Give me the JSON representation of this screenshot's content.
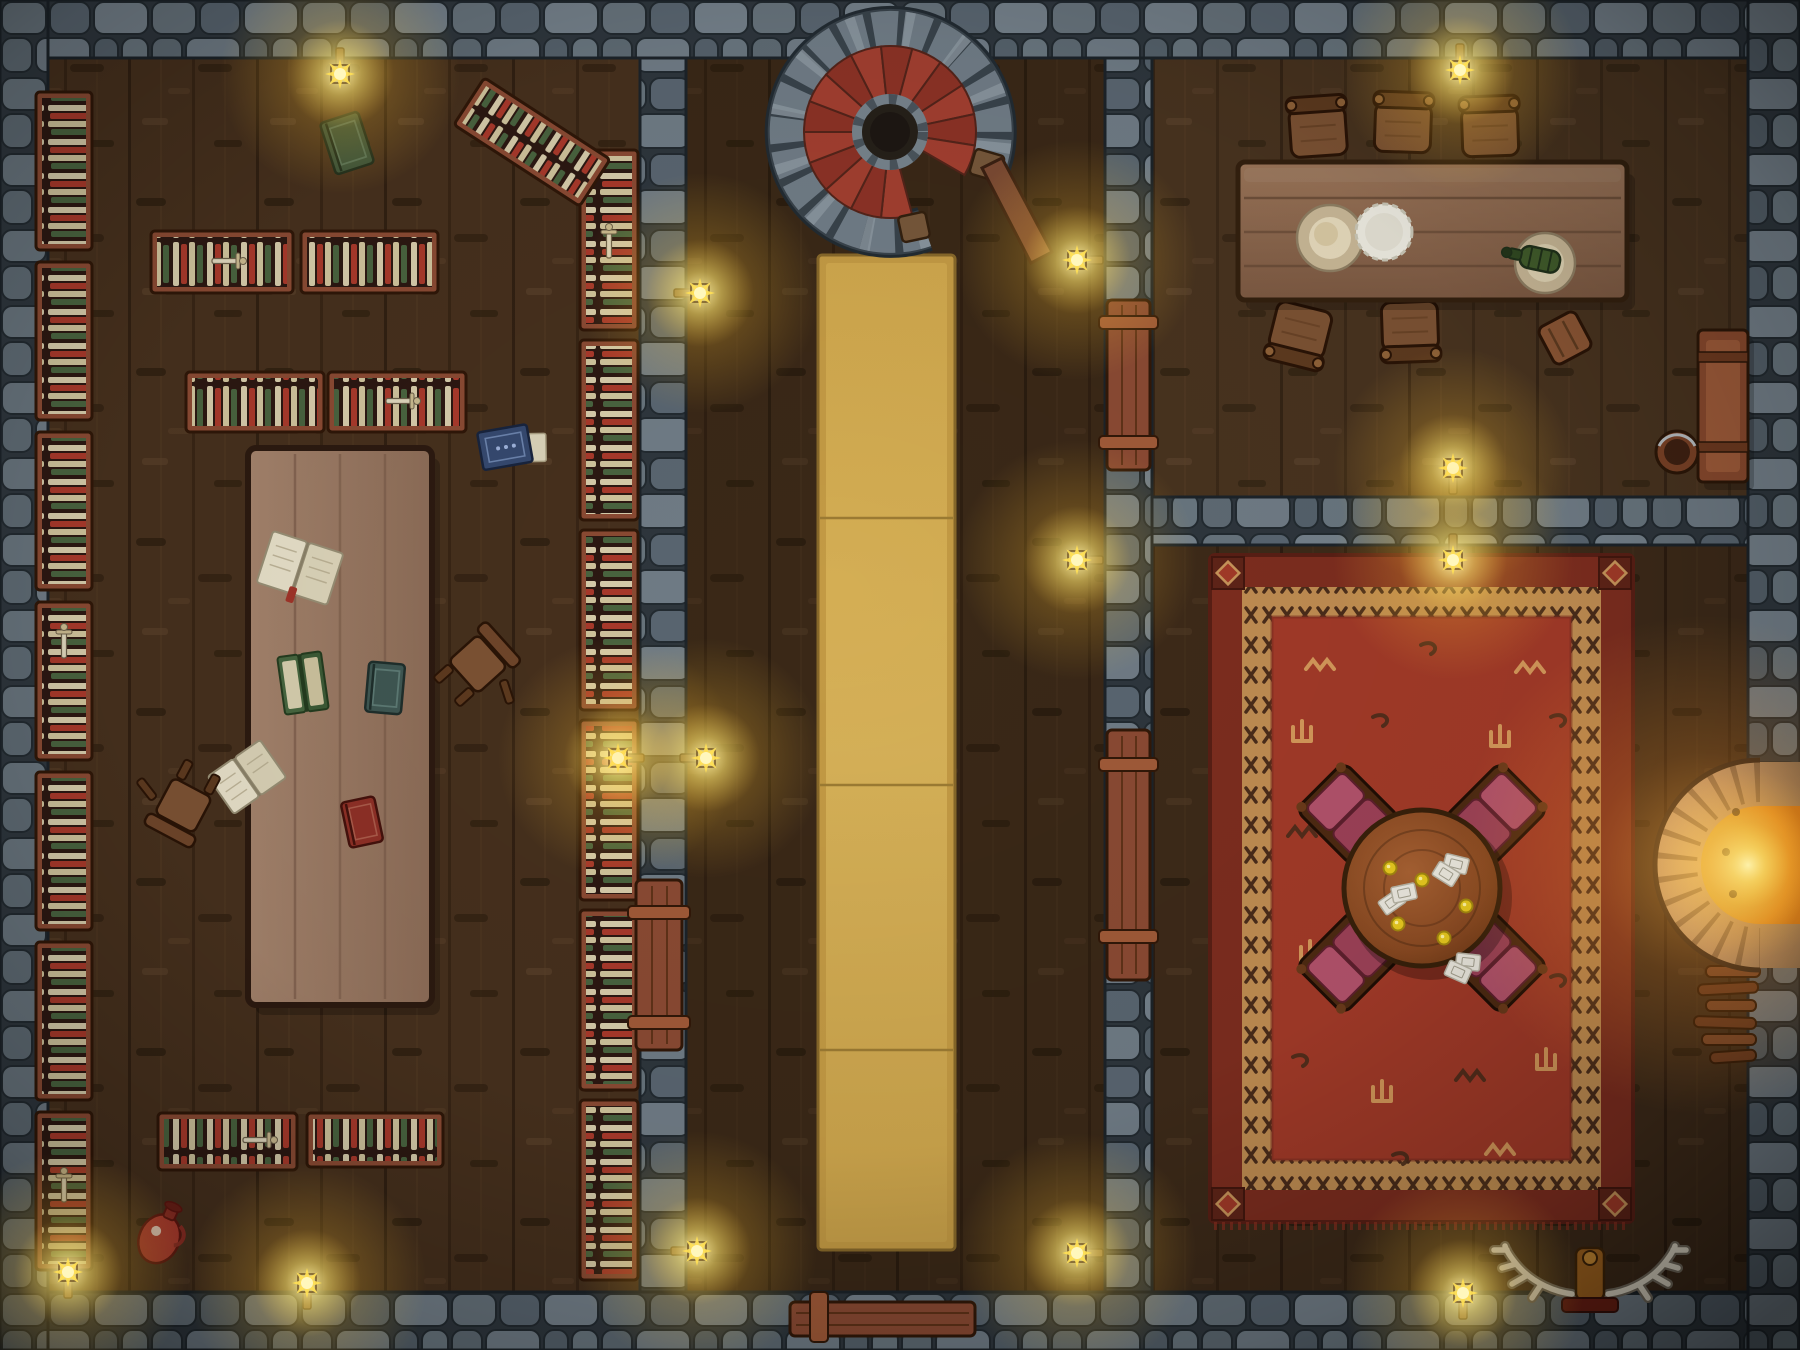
{
  "meta": {
    "type": "top-down fantasy battle map",
    "scene": "stone-walled tavern interior at night, lantern lit",
    "canvas": {
      "width": 1800,
      "height": 1350
    },
    "visible_text": "none"
  },
  "palette": {
    "floor_wood": "#46301d",
    "wall_stone": "#67737c",
    "wall_mortar": "#2e363d",
    "shelf_wood": "#8a4a33",
    "book_cream": "#d6cbaa",
    "book_red": "#a8392b",
    "book_green": "#49633f",
    "carpet_gold": "#c39a44",
    "rug_field_red": "#a23a28",
    "rug_border_red": "#7d2d1f",
    "rug_tan": "#c08d52",
    "lantern_glow": "#ffd84a",
    "fire_orange": "#ff9e22",
    "step_red": "#a23f30",
    "cushion_maroon": "#a84a63"
  },
  "rooms": [
    {
      "id": "library",
      "bounds": {
        "x": 48,
        "y": 58,
        "w": 592,
        "h": 1234
      },
      "contents": [
        "wall bookshelf columns",
        "freestanding bookshelves",
        "long reading table",
        "open books",
        "fallen chairs",
        "red jug"
      ]
    },
    {
      "id": "hallway",
      "bounds": {
        "x": 686,
        "y": 58,
        "w": 419,
        "h": 1234
      },
      "contents": [
        "spiral staircase",
        "gold carpet runner",
        "entrance door",
        "wall lanterns"
      ]
    },
    {
      "id": "dining-room",
      "bounds": {
        "x": 1152,
        "y": 58,
        "w": 596,
        "h": 439
      },
      "contents": [
        "long dining table",
        "five chairs and a stool",
        "plates",
        "doily",
        "green bottle",
        "bench",
        "bucket"
      ]
    },
    {
      "id": "lounge",
      "bounds": {
        "x": 1152,
        "y": 545,
        "w": 596,
        "h": 747
      },
      "contents": [
        "ornate red rug",
        "round card table",
        "four cushioned chairs",
        "playing cards",
        "gold coins",
        "stone fireplace",
        "firewood stack",
        "antler trophy"
      ]
    }
  ],
  "map": {
    "stair": {
      "cx": 890,
      "cy": 132,
      "r_steps_outer": 86,
      "r_steps_inner": 30,
      "steps": 15,
      "start_deg": 75,
      "sweep_deg": 315,
      "step_color_a": "#a23f30",
      "step_color_b": "#8c3226",
      "step_stroke": "#54241a"
    },
    "lights": [
      {
        "x": 340,
        "y": 74,
        "mount": "up"
      },
      {
        "x": 700,
        "y": 293,
        "mount": "left"
      },
      {
        "x": 1077,
        "y": 260,
        "mount": "right"
      },
      {
        "x": 1460,
        "y": 70,
        "mount": "up"
      },
      {
        "x": 1453,
        "y": 468,
        "mount": "down"
      },
      {
        "x": 1453,
        "y": 560,
        "mount": "up"
      },
      {
        "x": 618,
        "y": 758,
        "mount": "right"
      },
      {
        "x": 706,
        "y": 758,
        "mount": "left"
      },
      {
        "x": 1077,
        "y": 560,
        "mount": "right"
      },
      {
        "x": 697,
        "y": 1251,
        "mount": "left"
      },
      {
        "x": 1077,
        "y": 1253,
        "mount": "right"
      },
      {
        "x": 307,
        "y": 1283,
        "mount": "down"
      },
      {
        "x": 1463,
        "y": 1293,
        "mount": "down"
      },
      {
        "x": 68,
        "y": 1272,
        "mount": "down"
      }
    ],
    "library": {
      "shelves": [
        {
          "x": 36,
          "y": 92,
          "w": 56,
          "h": 158,
          "orient": "h"
        },
        {
          "x": 36,
          "y": 262,
          "w": 56,
          "h": 158,
          "orient": "h"
        },
        {
          "x": 36,
          "y": 432,
          "w": 56,
          "h": 158,
          "orient": "h"
        },
        {
          "x": 36,
          "y": 602,
          "w": 56,
          "h": 158,
          "orient": "h"
        },
        {
          "x": 36,
          "y": 772,
          "w": 56,
          "h": 158,
          "orient": "h"
        },
        {
          "x": 36,
          "y": 942,
          "w": 56,
          "h": 158,
          "orient": "h"
        },
        {
          "x": 36,
          "y": 1112,
          "w": 56,
          "h": 158,
          "orient": "h"
        },
        {
          "x": 580,
          "y": 150,
          "w": 58,
          "h": 180,
          "orient": "h"
        },
        {
          "x": 580,
          "y": 340,
          "w": 58,
          "h": 180,
          "orient": "h"
        },
        {
          "x": 580,
          "y": 530,
          "w": 58,
          "h": 180,
          "orient": "h"
        },
        {
          "x": 580,
          "y": 720,
          "w": 58,
          "h": 180,
          "orient": "h"
        },
        {
          "x": 580,
          "y": 910,
          "w": 58,
          "h": 180,
          "orient": "h"
        },
        {
          "x": 580,
          "y": 1100,
          "w": 58,
          "h": 180,
          "orient": "h"
        },
        {
          "x": 151,
          "y": 231,
          "w": 142,
          "h": 62,
          "orient": "v"
        },
        {
          "x": 301,
          "y": 231,
          "w": 137,
          "h": 62,
          "orient": "v"
        },
        {
          "x": 186,
          "y": 372,
          "w": 138,
          "h": 60,
          "orient": "v"
        },
        {
          "x": 328,
          "y": 372,
          "w": 138,
          "h": 60,
          "orient": "v"
        },
        {
          "x": 158,
          "y": 1113,
          "w": 139,
          "h": 57,
          "orient": "v"
        },
        {
          "x": 307,
          "y": 1113,
          "w": 136,
          "h": 54,
          "orient": "v"
        },
        {
          "x": 457,
          "y": 114,
          "w": 150,
          "h": 56,
          "orient": "v",
          "rot": 33
        }
      ],
      "daggers": [
        {
          "x": 222,
          "y": 261,
          "rot": 90
        },
        {
          "x": 253,
          "y": 1140,
          "rot": 90
        },
        {
          "x": 396,
          "y": 401,
          "rot": 90
        },
        {
          "x": 609,
          "y": 248,
          "rot": 0
        },
        {
          "x": 64,
          "y": 648,
          "rot": 0
        },
        {
          "x": 64,
          "y": 1192,
          "rot": 0
        }
      ],
      "reading_table": {
        "x": 248,
        "y": 448,
        "w": 184,
        "h": 557
      }
    },
    "lounge": {
      "rug": {
        "x": 1210,
        "y": 555,
        "w": 423,
        "h": 667,
        "motifs": [
          {
            "x": 1320,
            "y": 665,
            "t": "zig",
            "c": "tan"
          },
          {
            "x": 1430,
            "y": 650,
            "t": "hook",
            "c": "dark"
          },
          {
            "x": 1530,
            "y": 668,
            "t": "zig",
            "c": "tan"
          },
          {
            "x": 1302,
            "y": 732,
            "t": "trident",
            "c": "tan"
          },
          {
            "x": 1382,
            "y": 722,
            "t": "hook",
            "c": "dark"
          },
          {
            "x": 1500,
            "y": 737,
            "t": "trident",
            "c": "tan"
          },
          {
            "x": 1560,
            "y": 722,
            "t": "hook",
            "c": "dark"
          },
          {
            "x": 1302,
            "y": 832,
            "t": "zig",
            "c": "dark"
          },
          {
            "x": 1310,
            "y": 952,
            "t": "trident",
            "c": "tan"
          },
          {
            "x": 1302,
            "y": 1062,
            "t": "hook",
            "c": "dark"
          },
          {
            "x": 1382,
            "y": 1092,
            "t": "trident",
            "c": "tan"
          },
          {
            "x": 1470,
            "y": 1076,
            "t": "zig",
            "c": "dark"
          },
          {
            "x": 1546,
            "y": 1060,
            "t": "trident",
            "c": "tan"
          },
          {
            "x": 1402,
            "y": 1160,
            "t": "hook",
            "c": "dark"
          },
          {
            "x": 1500,
            "y": 1150,
            "t": "zig",
            "c": "tan"
          },
          {
            "x": 1560,
            "y": 982,
            "t": "hook",
            "c": "dark"
          }
        ]
      },
      "card_table": {
        "cx": 1422,
        "cy": 888,
        "r": 78,
        "cards": [
          {
            "x": 1392,
            "y": 902,
            "rot": -35
          },
          {
            "x": 1404,
            "y": 893,
            "rot": -12
          },
          {
            "x": 1456,
            "y": 864,
            "rot": 14
          },
          {
            "x": 1446,
            "y": 874,
            "rot": 32
          },
          {
            "x": 1468,
            "y": 962,
            "rot": 6
          },
          {
            "x": 1458,
            "y": 972,
            "rot": 24
          }
        ],
        "coins": [
          {
            "x": 1390,
            "y": 868
          },
          {
            "x": 1422,
            "y": 880
          },
          {
            "x": 1398,
            "y": 924
          },
          {
            "x": 1444,
            "y": 938
          },
          {
            "x": 1466,
            "y": 906
          }
        ]
      }
    }
  }
}
